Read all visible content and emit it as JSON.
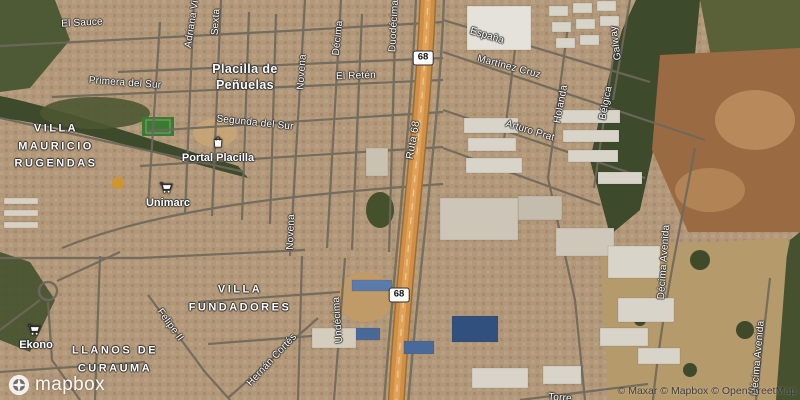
{
  "map": {
    "attribution": "© Maxar © Mapbox © OpenStreetMap",
    "logo_text": "mapbox",
    "colors": {
      "land": "#b29878",
      "forest": "#3d4a2b",
      "bare_hill": "#9a6a42",
      "highway_orange": "#d18f45",
      "road_gray": "#6e685c",
      "label_white": "#ffffff",
      "shield_bg": "#fbfbf7",
      "shield_text": "#111111"
    },
    "town_labels": [
      {
        "lines": [
          "Placilla de",
          "Peñuelas"
        ],
        "x": 245,
        "y": 77
      }
    ],
    "area_labels": [
      {
        "lines": [
          "VILLA",
          "MAURICIO",
          "RUGENDAS"
        ],
        "x": 56,
        "y": 147
      },
      {
        "lines": [
          "VILLA",
          "FUNDADORES"
        ],
        "x": 240,
        "y": 299
      },
      {
        "lines": [
          "LLANOS DE",
          "CURAUMA"
        ],
        "x": 115,
        "y": 360
      }
    ],
    "street_labels": [
      {
        "text": "El Sauce",
        "x": 82,
        "y": 23,
        "rot": -3
      },
      {
        "text": "Adriana Vi",
        "x": 192,
        "y": 24,
        "rot": -81
      },
      {
        "text": "Sexta",
        "x": 216,
        "y": 22,
        "rot": -86
      },
      {
        "text": "Primera del Sur",
        "x": 125,
        "y": 83,
        "rot": 4
      },
      {
        "text": "Segunda del Sur",
        "x": 255,
        "y": 123,
        "rot": 6
      },
      {
        "text": "Novena",
        "x": 302,
        "y": 72,
        "rot": -86
      },
      {
        "text": "Décima",
        "x": 338,
        "y": 38,
        "rot": -84
      },
      {
        "text": "Duodécima",
        "x": 394,
        "y": 26,
        "rot": -87
      },
      {
        "text": "El Retén",
        "x": 356,
        "y": 76,
        "rot": -2
      },
      {
        "text": "España",
        "x": 487,
        "y": 36,
        "rot": 17
      },
      {
        "text": "Martínez Cruz",
        "x": 509,
        "y": 67,
        "rot": 15
      },
      {
        "text": "Arturo Prat",
        "x": 530,
        "y": 131,
        "rot": 17
      },
      {
        "text": "Galway",
        "x": 616,
        "y": 43,
        "rot": -98
      },
      {
        "text": "Holanda",
        "x": 561,
        "y": 104,
        "rot": -79
      },
      {
        "text": "Bélgica",
        "x": 606,
        "y": 103,
        "rot": -79
      },
      {
        "text": "Novena",
        "x": 291,
        "y": 232,
        "rot": -88
      },
      {
        "text": "Undécima",
        "x": 338,
        "y": 320,
        "rot": -94
      },
      {
        "text": "Felipe II",
        "x": 170,
        "y": 325,
        "rot": 54
      },
      {
        "text": "Hernán Cortés",
        "x": 272,
        "y": 360,
        "rot": -47
      },
      {
        "text": "Décima Avenida",
        "x": 664,
        "y": 262,
        "rot": -86
      },
      {
        "text": "Décima Avenida",
        "x": 758,
        "y": 358,
        "rot": -85
      },
      {
        "text": "Torre",
        "x": 560,
        "y": 398,
        "rot": 4
      }
    ],
    "route_labels": [
      {
        "text": "Ruta 68",
        "x": 413,
        "y": 140,
        "rot": -80
      }
    ],
    "shields": [
      {
        "text": "68",
        "x": 423,
        "y": 58
      },
      {
        "text": "68",
        "x": 399,
        "y": 295
      }
    ],
    "poi_labels": [
      {
        "text": "Portal Placilla",
        "icon": "shopping-bag-icon",
        "x": 218,
        "y": 158,
        "icon_x": 218,
        "icon_y": 142
      },
      {
        "text": "Unimarc",
        "icon": "shopping-cart-icon",
        "x": 168,
        "y": 203,
        "icon_x": 166,
        "icon_y": 188
      },
      {
        "text": "Ekono",
        "icon": "shopping-cart-icon",
        "x": 36,
        "y": 345,
        "icon_x": 34,
        "icon_y": 330
      }
    ]
  }
}
